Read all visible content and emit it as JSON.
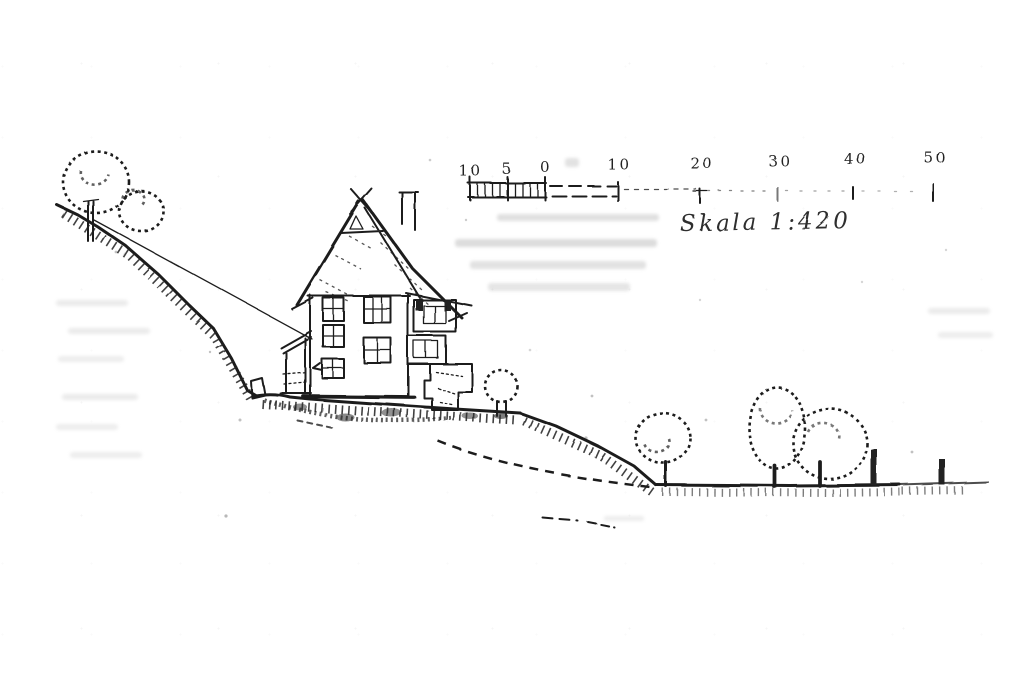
{
  "scale_bar": {
    "tick_labels": [
      "10",
      "5",
      "0",
      "10",
      "20",
      "30",
      "40",
      "50"
    ],
    "label": "Skala 1:420"
  },
  "colors": {
    "ink": "#1f1f1f",
    "paper": "#ffffff",
    "ghost_bleedthrough": "#8c8c8c"
  }
}
